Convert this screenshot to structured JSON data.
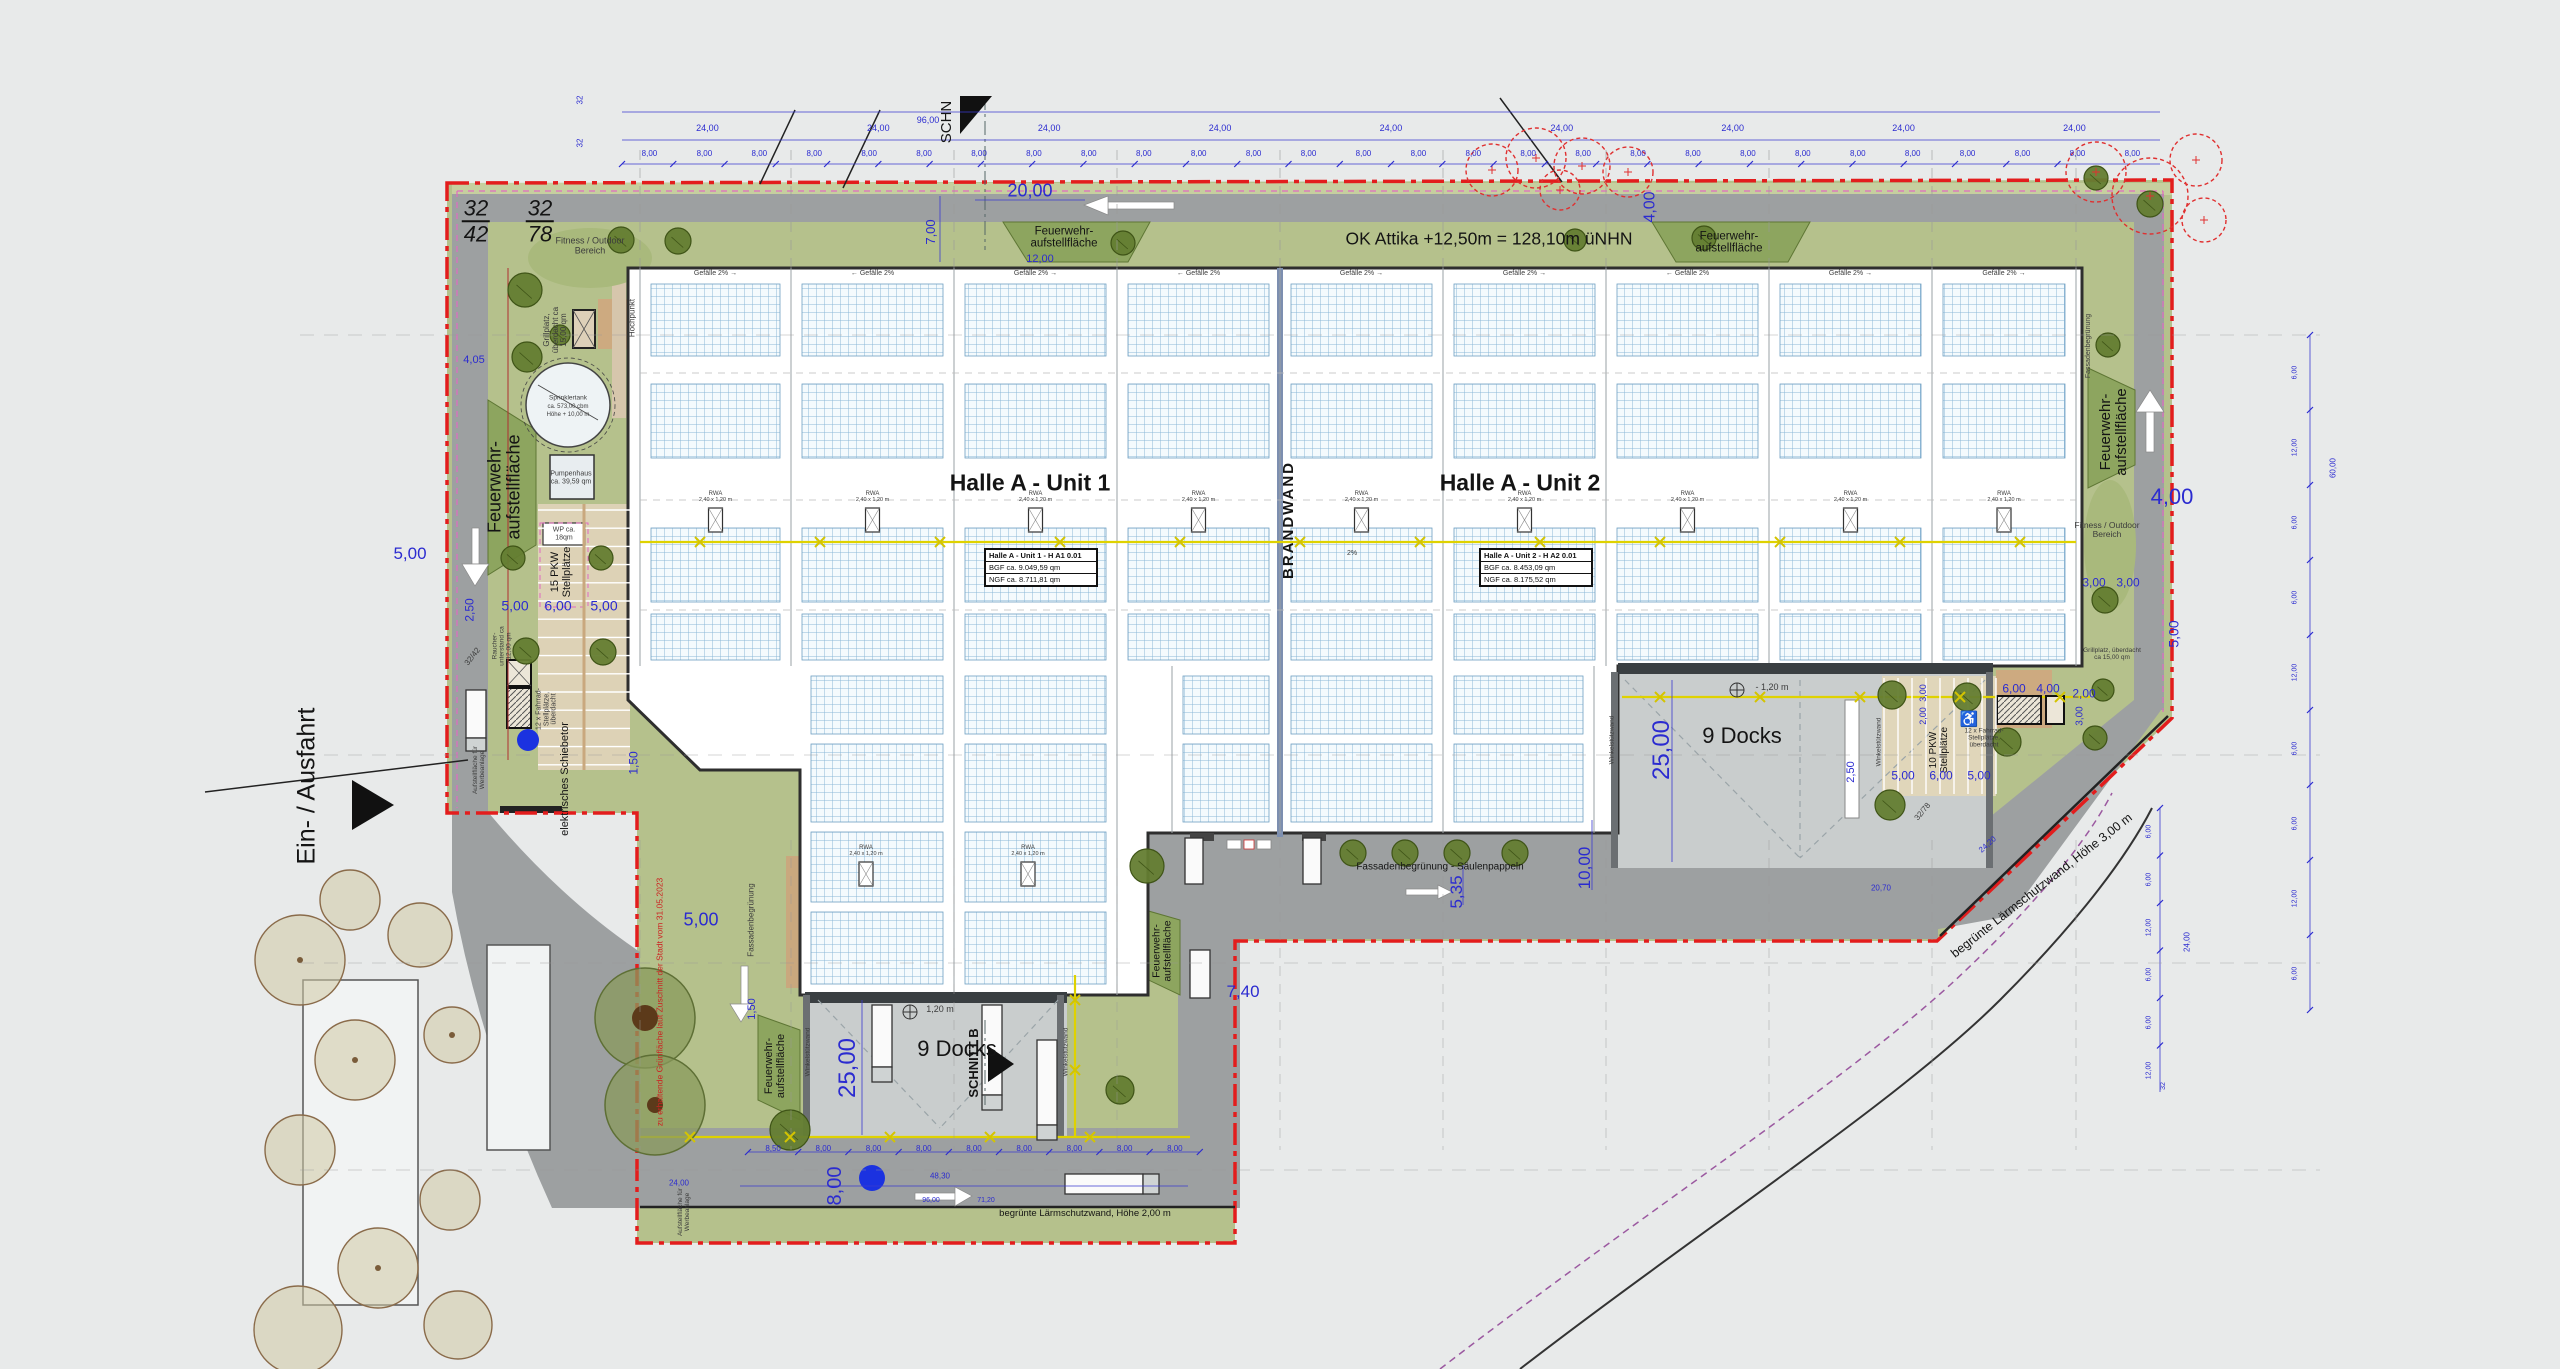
{
  "plan": {
    "titles": {
      "unit1": "Halle A - Unit 1",
      "unit2": "Halle A - Unit 2",
      "brandwand": "BRANDWAND",
      "attika_note": "OK Attika +12,50m = 128,10m üNHN"
    },
    "tables": {
      "unit1": {
        "name": "Halle A - Unit 1 - H A1 0.01",
        "bgf": "BGF ca. 9.049,59 qm",
        "ngf": "NGF ca. 8.711,81 qm"
      },
      "unit2": {
        "name": "Halle A - Unit 2 - H A2 0.01",
        "bgf": "BGF ca. 8.453,09 qm",
        "ngf": "NGF ca. 8.175,52 qm"
      }
    },
    "labels": {
      "fire": "Feuerwehr- aufstellfläche",
      "docks": "9 Docks",
      "schnitt_b": "SCHNITT B",
      "schn": "SCHN",
      "entrance": "Ein- / Ausfahrt",
      "gate": "elektrisches Schiebetor",
      "billboard": "Aufstellfläche für Werbeanlage",
      "bike": "12 x Fahrrad- Stellplätze, überdacht",
      "pkw15": "15 PKW Stellplätze",
      "pkw10": "10 PKW Stellplätze",
      "smoking": "Raucher- unterstand ca 12,00 qm",
      "fitness": "Fitness / Outdoor Bereich",
      "grill": "Grillplatz, überdacht ca 15,00 qm",
      "sprinkler1": "Sprinklertank",
      "sprinkler2": "ca. 573,00 cbm",
      "sprinkler3": "Höhe + 10,00 m",
      "pump": "Pumpenhaus ca. 39,59 qm",
      "wp": "WP ca. 18qm",
      "hochpunkt": "Hochpunkt",
      "wall_corner": "Winkelstützwand",
      "slope_r": "Gefälle 2% →",
      "slope_l": "← Gefälle 2%",
      "slope2": "2%",
      "rwa": "RWA",
      "rwa_size": "2,40 x 1,20 m",
      "facade": "Fassadenbegrünung - Säulenpappeln",
      "facade2": "Fassadenbegrünung",
      "noise2": "begrünte Lärmschutzwand, Höhe 2,00 m",
      "noise3": "begrünte Lärmschutzwand, Höhe 3,00 m",
      "preserve": "zu erhaltende Grünfläche laut Zuschnitt der Stadt vom 31.05.2023",
      "frac_a_top": "32",
      "frac_a_bot": "42",
      "frac_b_top": "32",
      "frac_b_bot": "78",
      "road_a": "32/42",
      "road_b": "32/78",
      "wheelchair": "♿"
    },
    "dims": {
      "w20": "20,00",
      "w4": "4,00",
      "w7": "7,00",
      "w12": "12,00",
      "w96": "96,00",
      "w32": "32",
      "w5": "5,00",
      "w6": "6,00",
      "w2_5": "2,50",
      "w1_5": "1,50",
      "w25": "25,00",
      "w8": "8,00",
      "w1_2": "1,20 m",
      "w1_2m": "- 1,20 m",
      "w4_05": "4,05",
      "w3": "3,00",
      "w2": "2,00",
      "w7_4": "7,40",
      "w5_35": "5,35",
      "w10": "10,00",
      "w48_3": "48,30",
      "w71_2": "71,20",
      "w24": "24,00",
      "w60": "60,00",
      "w20_7": "20,70",
      "w24_2": "24,20"
    },
    "chains": {
      "top_24": [
        "24,00",
        "24,00",
        "24,00",
        "24,00",
        "24,00",
        "24,00",
        "24,00",
        "24,00",
        "24,00"
      ],
      "top_8": [
        "8,00",
        "8,00",
        "8,00",
        "8,00",
        "8,00",
        "8,00",
        "8,00",
        "8,00",
        "8,00",
        "8,00",
        "8,00",
        "8,00",
        "8,00",
        "8,00",
        "8,00",
        "8,00",
        "8,00",
        "8,00",
        "8,00",
        "8,00",
        "8,00",
        "8,00",
        "8,00",
        "8,00",
        "8,00",
        "8,00",
        "8,00",
        "8,00"
      ],
      "bottom": [
        "8,50",
        "8,00",
        "8,00",
        "8,00",
        "8,00",
        "8,00",
        "8,00",
        "8,00",
        "8,00"
      ],
      "right_upper": [
        "6,00",
        "12,00",
        "6,00",
        "6,00",
        "12,00",
        "6,00",
        "6,00",
        "12,00",
        "6,00"
      ],
      "right_lower": [
        "6,00",
        "6,00",
        "12,00",
        "6,00",
        "6,00",
        "12,00"
      ]
    }
  }
}
